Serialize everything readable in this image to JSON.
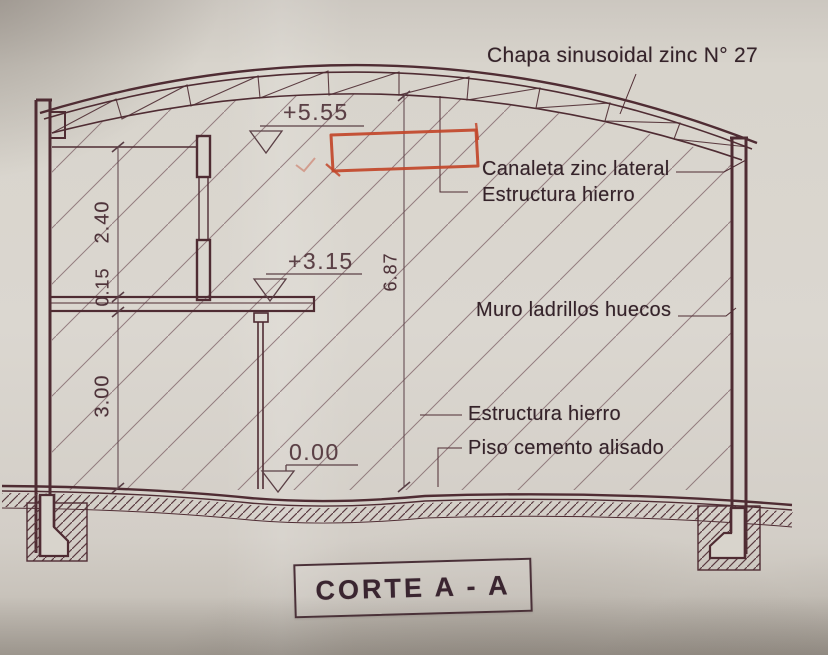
{
  "section": {
    "title": "CORTE A - A",
    "labels": {
      "roof_sheet": "Chapa sinusoidal zinc N° 27",
      "gutter": "Canaleta zinc lateral",
      "iron_structure_upper": "Estructura hierro",
      "brick_wall": "Muro ladrillos huecos",
      "iron_structure_lower": "Estructura hierro",
      "floor_finish": "Piso cemento alisado"
    },
    "levels": {
      "roof": "+5.55",
      "mezzanine": "+3.15",
      "ground": "0.00"
    },
    "dimensions": {
      "upper_height": "2.40",
      "slab_thickness": "0.15",
      "lower_height": "3.00",
      "total_height": "6.87"
    },
    "colors": {
      "ink": "#4f2c33",
      "annotation_red": "#c2462a",
      "paper": "#d6d2ca"
    }
  }
}
